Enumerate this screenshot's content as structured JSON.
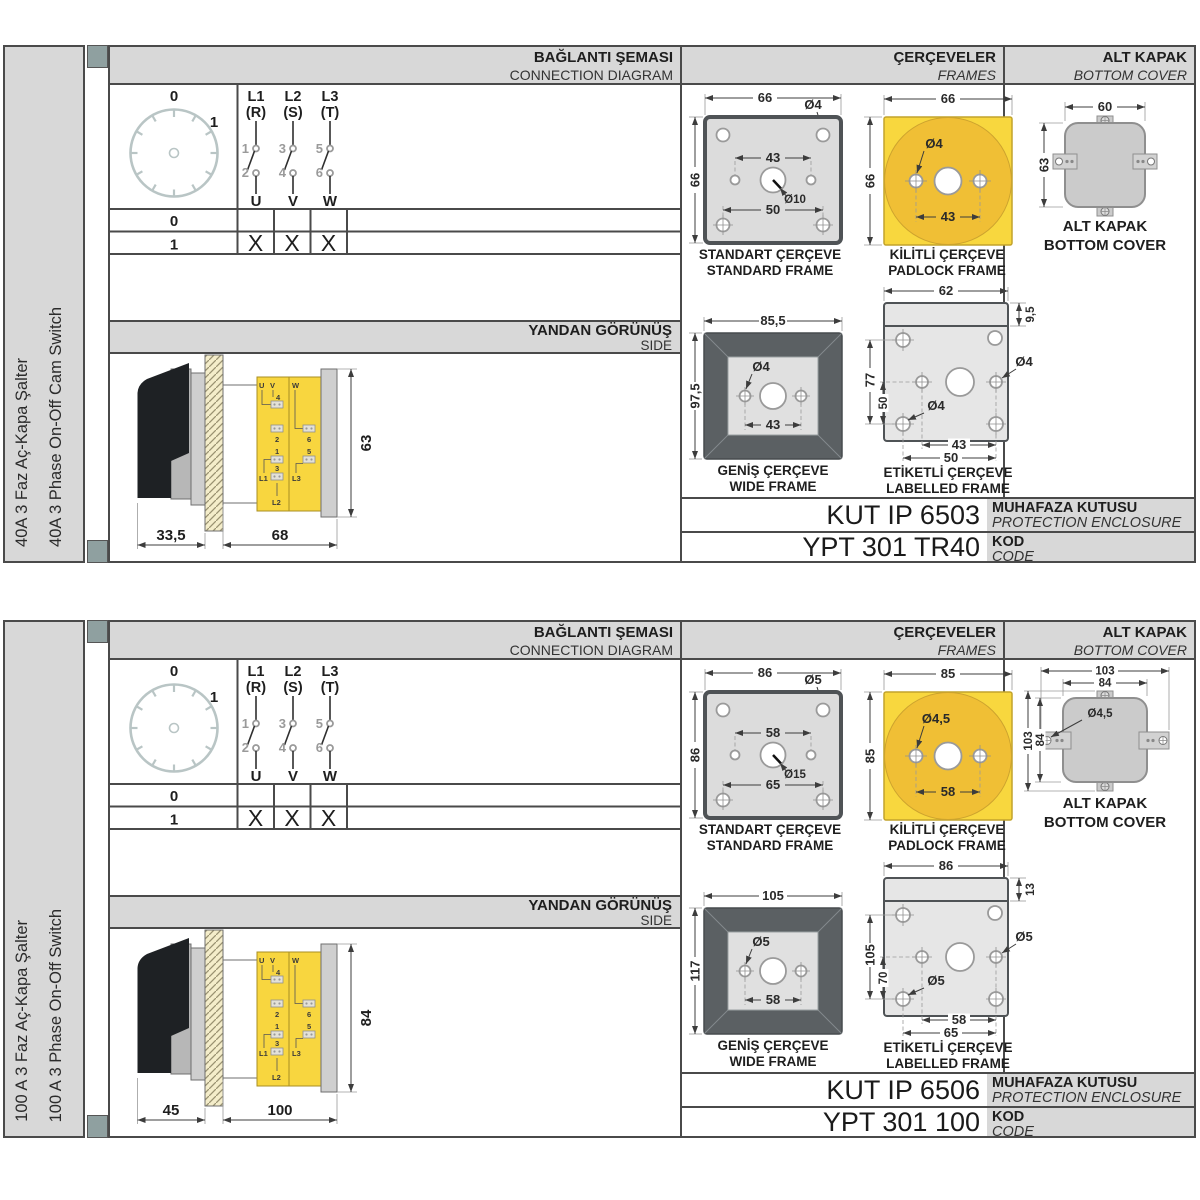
{
  "colors": {
    "header_bg": "#d8d8d8",
    "panel_border": "#4a4a4a",
    "corner_square": "#8fa0a0",
    "frame_yellow": "#f8d73e",
    "frame_yellow_dark": "#f0bf35",
    "frame_gray": "#dcdcdc",
    "frame_dark": "#5b6063",
    "hatch": "#f4edca",
    "dial": "#b9c5c5"
  },
  "panels": [
    {
      "side_label_tr": "40A 3 Faz Aç-Kapa Şalter",
      "side_label_en": "40A 3 Phase On-Off Cam Switch",
      "header": {
        "connection_tr": "BAĞLANTI ŞEMASI",
        "connection_en": "CONNECTION DIAGRAM",
        "frames_tr": "ÇERÇEVELER",
        "frames_en": "FRAMES",
        "cover_tr": "ALT KAPAK",
        "cover_en": "BOTTOM COVER"
      },
      "connection": {
        "dial": {
          "pos0": "0",
          "pos1": "1"
        },
        "phases": [
          {
            "line": "L1",
            "phase": "(R)",
            "top": "1",
            "bottom": "2",
            "out": "U"
          },
          {
            "line": "L2",
            "phase": "(S)",
            "top": "3",
            "bottom": "4",
            "out": "V"
          },
          {
            "line": "L3",
            "phase": "(T)",
            "top": "5",
            "bottom": "6",
            "out": "W"
          }
        ],
        "table": {
          "rows": [
            {
              "label": "0",
              "u": "",
              "v": "",
              "w": ""
            },
            {
              "label": "1",
              "u": "X",
              "v": "X",
              "w": "X"
            }
          ]
        }
      },
      "side_view": {
        "title_tr": "YANDAN GÖRÜNÜŞ",
        "title_en": "SIDE",
        "dim_handle": "33,5",
        "dim_body": "68",
        "dim_height": "63",
        "terminals": {
          "u": "U",
          "v": "V",
          "w": "W",
          "t1": "1",
          "t2": "2",
          "t3": "3",
          "t4": "4",
          "t5": "5",
          "t6": "6",
          "l1": "L1",
          "l2": "L2",
          "l3": "L3"
        }
      },
      "frames": {
        "standard": {
          "caption_tr": "STANDART ÇERÇEVE",
          "caption_en": "STANDARD FRAME",
          "dim_width": "66",
          "dim_height": "66",
          "dim_hole": "Ø4",
          "dim_inner": "43",
          "dim_center": "Ø10",
          "dim_bottom": "50"
        },
        "padlock": {
          "caption_tr": "KİLİTLİ ÇERÇEVE",
          "caption_en": "PADLOCK FRAME",
          "dim_width": "66",
          "dim_height": "66",
          "dim_hole": "Ø4",
          "dim_inner": "43"
        },
        "wide": {
          "caption_tr": "GENİŞ ÇERÇEVE",
          "caption_en": "WIDE FRAME",
          "dim_width": "85,5",
          "dim_height": "97,5",
          "dim_hole": "Ø4",
          "dim_inner": "43"
        },
        "labelled": {
          "caption_tr": "ETİKETLİ ÇERÇEVE",
          "caption_en": "LABELLED FRAME",
          "dim_width": "62",
          "dim_strip": "9,5",
          "dim_height": "77",
          "dim_inner_height": "50",
          "dim_hole_a": "Ø4",
          "dim_hole_b": "Ø4",
          "dim_inner": "43",
          "dim_bottom": "50"
        }
      },
      "cover": {
        "caption_tr": "ALT KAPAK",
        "caption_en": "BOTTOM COVER",
        "dim_width": "60",
        "dim_height": "63"
      },
      "codes": {
        "enclosure_code": "KUT IP 6503",
        "enclosure_label_tr": "MUHAFAZA KUTUSU",
        "enclosure_label_en": "PROTECTION ENCLOSURE",
        "product_code": "YPT 301 TR40",
        "code_label_tr": "KOD",
        "code_label_en": "CODE"
      }
    },
    {
      "side_label_tr": "100 A 3 Faz Aç-Kapa Şalter",
      "side_label_en": "100 A 3 Phase On-Off Switch",
      "header": {
        "connection_tr": "BAĞLANTI ŞEMASI",
        "connection_en": "CONNECTION DIAGRAM",
        "frames_tr": "ÇERÇEVELER",
        "frames_en": "FRAMES",
        "cover_tr": "ALT KAPAK",
        "cover_en": "BOTTOM COVER"
      },
      "connection": {
        "dial": {
          "pos0": "0",
          "pos1": "1"
        },
        "phases": [
          {
            "line": "L1",
            "phase": "(R)",
            "top": "1",
            "bottom": "2",
            "out": "U"
          },
          {
            "line": "L2",
            "phase": "(S)",
            "top": "3",
            "bottom": "4",
            "out": "V"
          },
          {
            "line": "L3",
            "phase": "(T)",
            "top": "5",
            "bottom": "6",
            "out": "W"
          }
        ],
        "table": {
          "rows": [
            {
              "label": "0",
              "u": "",
              "v": "",
              "w": ""
            },
            {
              "label": "1",
              "u": "X",
              "v": "X",
              "w": "X"
            }
          ]
        }
      },
      "side_view": {
        "title_tr": "YANDAN GÖRÜNÜŞ",
        "title_en": "SIDE",
        "dim_handle": "45",
        "dim_body": "100",
        "dim_height": "84",
        "terminals": {
          "u": "U",
          "v": "V",
          "w": "W",
          "t1": "1",
          "t2": "2",
          "t3": "3",
          "t4": "4",
          "t5": "5",
          "t6": "6",
          "l1": "L1",
          "l2": "L2",
          "l3": "L3"
        }
      },
      "frames": {
        "standard": {
          "caption_tr": "STANDART ÇERÇEVE",
          "caption_en": "STANDARD FRAME",
          "dim_width": "86",
          "dim_height": "86",
          "dim_hole": "Ø5",
          "dim_inner": "58",
          "dim_center": "Ø15",
          "dim_bottom": "65"
        },
        "padlock": {
          "caption_tr": "KİLİTLİ ÇERÇEVE",
          "caption_en": "PADLOCK FRAME",
          "dim_width": "85",
          "dim_height": "85",
          "dim_hole": "Ø4,5",
          "dim_inner": "58"
        },
        "wide": {
          "caption_tr": "GENİŞ ÇERÇEVE",
          "caption_en": "WIDE FRAME",
          "dim_width": "105",
          "dim_height": "117",
          "dim_hole": "Ø5",
          "dim_inner": "58"
        },
        "labelled": {
          "caption_tr": "ETİKETLİ ÇERÇEVE",
          "caption_en": "LABELLED FRAME",
          "dim_width": "86",
          "dim_strip": "13",
          "dim_height": "105",
          "dim_inner_height": "70",
          "dim_hole_a": "Ø5",
          "dim_hole_b": "Ø5",
          "dim_inner": "58",
          "dim_bottom": "65"
        }
      },
      "cover": {
        "caption_tr": "ALT KAPAK",
        "caption_en": "BOTTOM COVER",
        "dim_width_outer": "103",
        "dim_width_inner": "84",
        "dim_height_outer": "103",
        "dim_height_inner": "84",
        "dim_hole": "Ø4,5"
      },
      "codes": {
        "enclosure_code": "KUT IP 6506",
        "enclosure_label_tr": "MUHAFAZA KUTUSU",
        "enclosure_label_en": "PROTECTION ENCLOSURE",
        "product_code": "YPT 301 100",
        "code_label_tr": "KOD",
        "code_label_en": "CODE"
      }
    }
  ]
}
